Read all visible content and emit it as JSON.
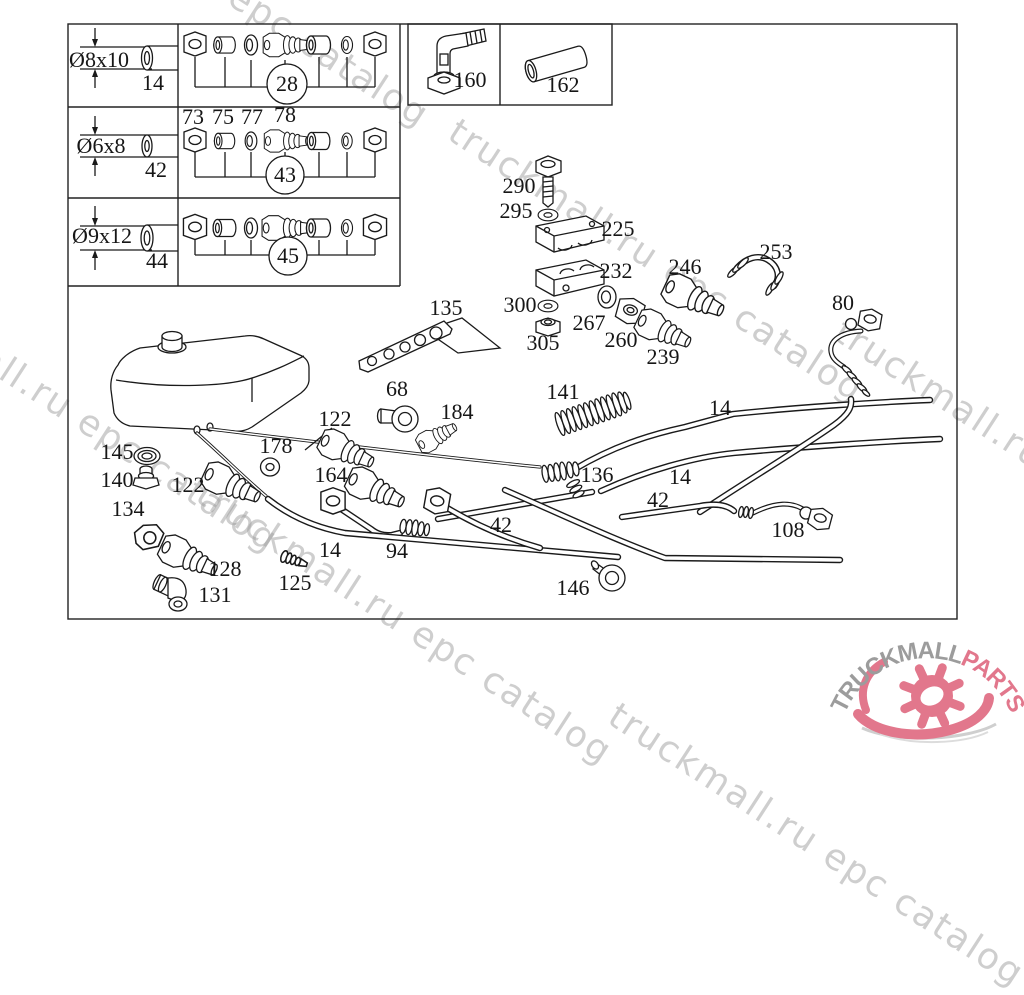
{
  "watermark": {
    "text": "truckmall.ru epc catalog",
    "color": "#9e9e9e",
    "angle_deg": 33,
    "tiles": [
      {
        "x": 17,
        "y": -167
      },
      {
        "x": 452,
        "y": 108
      },
      {
        "x": 838,
        "y": 308
      },
      {
        "x": -134,
        "y": 258
      },
      {
        "x": 200,
        "y": 470
      },
      {
        "x": 612,
        "y": 692
      }
    ]
  },
  "logo": {
    "brand_gray": "TRUCKMALL",
    "brand_pink": "PARTS",
    "gray_color": "#9c9c9c",
    "pink_color": "#e2778c"
  },
  "legend": {
    "rows": [
      {
        "diameter": "Ø8x10",
        "length": "14",
        "group_number": "28",
        "item_numbers": []
      },
      {
        "diameter": "Ø6x8",
        "length": "42",
        "group_number": "43",
        "item_numbers": [
          "73",
          "75",
          "77",
          "78"
        ]
      },
      {
        "diameter": "Ø9x12",
        "length": "44",
        "group_number": "45",
        "item_numbers": []
      }
    ],
    "part_boxes": [
      "160",
      "162"
    ]
  },
  "callouts": [
    {
      "name": "dim-8x10",
      "text": "Ø8x10",
      "x": 99,
      "y": 60
    },
    {
      "name": "dim-8x10-len",
      "text": "14",
      "x": 153,
      "y": 83
    },
    {
      "name": "group-28",
      "text": "28",
      "x": 287,
      "y": 84
    },
    {
      "name": "dim-6x8",
      "text": "Ø6x8",
      "x": 101,
      "y": 146
    },
    {
      "name": "dim-6x8-len",
      "text": "42",
      "x": 156,
      "y": 170
    },
    {
      "name": "group-43",
      "text": "43",
      "x": 285,
      "y": 175
    },
    {
      "name": "sub-73",
      "text": "73",
      "x": 193,
      "y": 117
    },
    {
      "name": "sub-75",
      "text": "75",
      "x": 223,
      "y": 117
    },
    {
      "name": "sub-77",
      "text": "77",
      "x": 252,
      "y": 117
    },
    {
      "name": "sub-78",
      "text": "78",
      "x": 285,
      "y": 115
    },
    {
      "name": "dim-9x12",
      "text": "Ø9x12",
      "x": 102,
      "y": 236
    },
    {
      "name": "dim-9x12-len",
      "text": "44",
      "x": 157,
      "y": 261
    },
    {
      "name": "group-45",
      "text": "45",
      "x": 288,
      "y": 256
    },
    {
      "name": "part-160",
      "text": "160",
      "x": 470,
      "y": 80
    },
    {
      "name": "part-162",
      "text": "162",
      "x": 563,
      "y": 85
    },
    {
      "name": "part-290",
      "text": "290",
      "x": 519,
      "y": 186
    },
    {
      "name": "part-295",
      "text": "295",
      "x": 516,
      "y": 211
    },
    {
      "name": "part-225",
      "text": "225",
      "x": 618,
      "y": 229
    },
    {
      "name": "part-232",
      "text": "232",
      "x": 616,
      "y": 271
    },
    {
      "name": "part-300",
      "text": "300",
      "x": 520,
      "y": 305
    },
    {
      "name": "part-267",
      "text": "267",
      "x": 589,
      "y": 323
    },
    {
      "name": "part-305",
      "text": "305",
      "x": 543,
      "y": 343
    },
    {
      "name": "part-260",
      "text": "260",
      "x": 621,
      "y": 340
    },
    {
      "name": "part-239",
      "text": "239",
      "x": 663,
      "y": 357
    },
    {
      "name": "part-246",
      "text": "246",
      "x": 685,
      "y": 267
    },
    {
      "name": "part-253",
      "text": "253",
      "x": 776,
      "y": 252
    },
    {
      "name": "part-80",
      "text": "80",
      "x": 843,
      "y": 303
    },
    {
      "name": "part-135",
      "text": "135",
      "x": 446,
      "y": 308
    },
    {
      "name": "part-68",
      "text": "68",
      "x": 397,
      "y": 389
    },
    {
      "name": "part-184",
      "text": "184",
      "x": 457,
      "y": 412
    },
    {
      "name": "part-141",
      "text": "141",
      "x": 563,
      "y": 392
    },
    {
      "name": "part-14-top",
      "text": "14",
      "x": 720,
      "y": 408
    },
    {
      "name": "part-14-mid",
      "text": "14",
      "x": 680,
      "y": 477
    },
    {
      "name": "part-136",
      "text": "136",
      "x": 597,
      "y": 475
    },
    {
      "name": "part-42-right",
      "text": "42",
      "x": 658,
      "y": 500
    },
    {
      "name": "part-42-left",
      "text": "42",
      "x": 501,
      "y": 525
    },
    {
      "name": "part-122-top",
      "text": "122",
      "x": 335,
      "y": 419
    },
    {
      "name": "part-178",
      "text": "178",
      "x": 276,
      "y": 446
    },
    {
      "name": "part-164",
      "text": "164",
      "x": 331,
      "y": 475
    },
    {
      "name": "part-122-left",
      "text": "122",
      "x": 188,
      "y": 485
    },
    {
      "name": "part-145",
      "text": "145",
      "x": 117,
      "y": 452
    },
    {
      "name": "part-140",
      "text": "140",
      "x": 117,
      "y": 480
    },
    {
      "name": "part-134",
      "text": "134",
      "x": 128,
      "y": 509
    },
    {
      "name": "part-128",
      "text": "128",
      "x": 225,
      "y": 569
    },
    {
      "name": "part-131",
      "text": "131",
      "x": 215,
      "y": 595
    },
    {
      "name": "part-125",
      "text": "125",
      "x": 295,
      "y": 583
    },
    {
      "name": "part-14-bl",
      "text": "14",
      "x": 330,
      "y": 550
    },
    {
      "name": "part-94",
      "text": "94",
      "x": 397,
      "y": 551
    },
    {
      "name": "part-146",
      "text": "146",
      "x": 573,
      "y": 588
    },
    {
      "name": "part-108",
      "text": "108",
      "x": 788,
      "y": 530
    }
  ]
}
